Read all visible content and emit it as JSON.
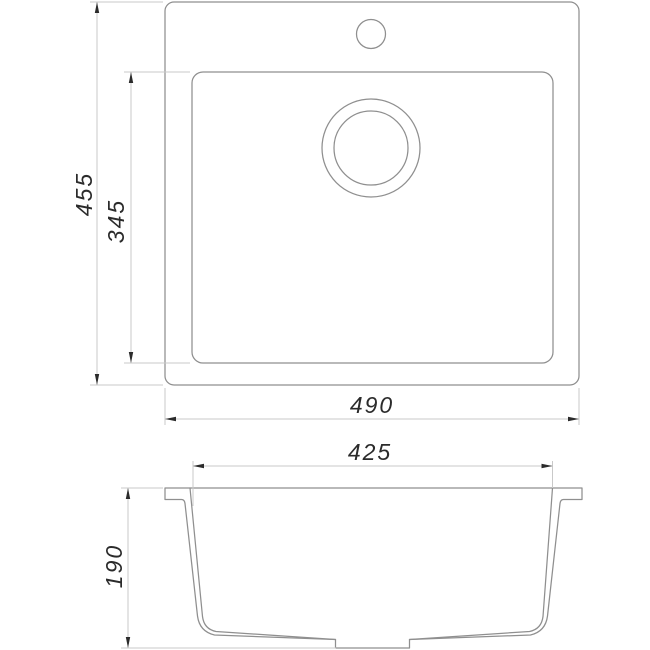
{
  "drawing": {
    "title": "Sink dimensional drawing",
    "object": "single-bowl kitchen sink",
    "views": {
      "top_view": {
        "description": "plan view with outer rim, inner bowl, faucet hole and drain",
        "features": [
          "outer-rim-outline",
          "bowl-outline",
          "faucet-hole",
          "drain-flange-outer",
          "drain-flange-inner"
        ]
      },
      "side_view": {
        "description": "cross-section with rim lip, tapered walls, sloped bottom and drain boss",
        "features": [
          "outer-profile",
          "inner-bowl-profile",
          "drain-boss"
        ]
      }
    }
  },
  "dimensions": {
    "overall_depth": {
      "value": "455",
      "orientation": "vertical",
      "view": "top"
    },
    "bowl_depth": {
      "value": "345",
      "orientation": "vertical",
      "view": "top"
    },
    "overall_width": {
      "value": "490",
      "orientation": "horizontal",
      "view": "top"
    },
    "bowl_width": {
      "value": "425",
      "orientation": "horizontal",
      "view": "side"
    },
    "bowl_height": {
      "value": "190",
      "orientation": "vertical",
      "view": "side"
    }
  },
  "colors": {
    "object_line": "#8f8f8f",
    "dimension_line": "#c9c9c9",
    "annotation": "#2b2b2b",
    "background": "#ffffff"
  }
}
